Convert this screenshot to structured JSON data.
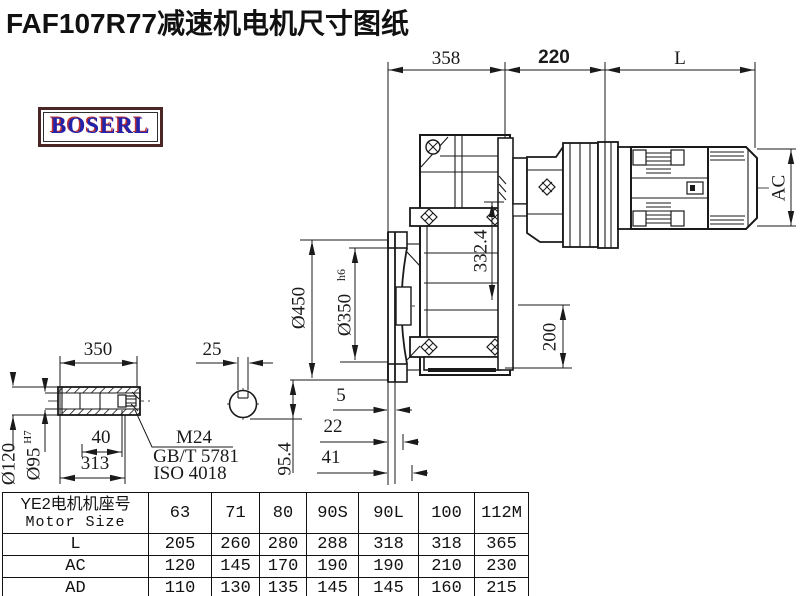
{
  "title": "FAF107R77减速机电机尺寸图纸",
  "logo": {
    "text": "BOSERL"
  },
  "colors": {
    "line": "#1a1a1a",
    "logo_blue": "#2222aa",
    "logo_red": "#c03030",
    "logo_border": "#4a2626"
  },
  "dims": {
    "top_width": "358",
    "top_mid": "220",
    "motor_len": "L",
    "motor_height": "AC",
    "gear_height": "332.4",
    "bottom_height": "200",
    "flange_od": "Ø450",
    "spigot_d": "Ø350",
    "spigot_tol": "h6",
    "face_5": "5",
    "face_22": "22",
    "face_41": "41",
    "shaft_len": "350",
    "key_w": "25",
    "hub_od": "Ø120",
    "bore_d": "Ø95",
    "bore_tol": "H7",
    "key_40": "40",
    "len_313": "313",
    "off_954": "95.4",
    "bolt": "M24",
    "std1": "GB/T 5781",
    "std2": "ISO 4018"
  },
  "table": {
    "header_cn": "YE2电机机座号",
    "header_en": "Motor Size",
    "columns": [
      "63",
      "71",
      "80",
      "90S",
      "90L",
      "100",
      "112M"
    ],
    "rows": [
      {
        "label": "L",
        "values": [
          "205",
          "260",
          "280",
          "288",
          "318",
          "318",
          "365"
        ]
      },
      {
        "label": "AC",
        "values": [
          "120",
          "145",
          "170",
          "190",
          "190",
          "210",
          "230"
        ]
      },
      {
        "label": "AD",
        "values": [
          "110",
          "130",
          "135",
          "145",
          "145",
          "160",
          "215"
        ]
      }
    ]
  }
}
